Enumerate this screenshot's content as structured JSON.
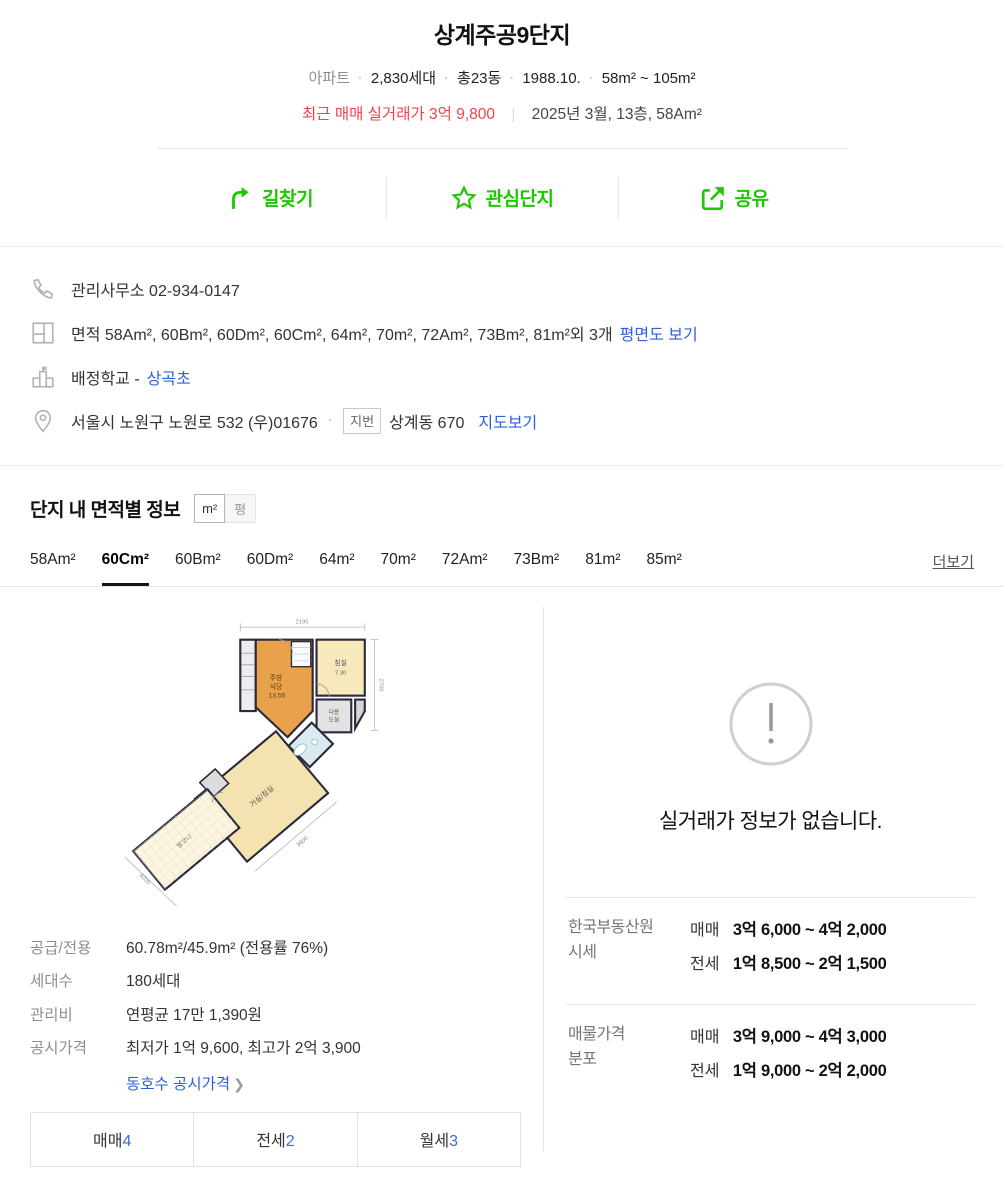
{
  "colors": {
    "accent_green": "#1ec800",
    "price_red": "#f1434b",
    "link_blue": "#3060dd",
    "count_blue": "#3b6bd6"
  },
  "header": {
    "title": "상계주공9단지",
    "meta": [
      "아파트",
      "2,830세대",
      "총23동",
      "1988.10.",
      "58m² ~ 105m²"
    ],
    "recent_price": "최근 매매 실거래가 3억 9,800",
    "recent_detail": "2025년 3월, 13층, 58Am²"
  },
  "actions": [
    {
      "label": "길찾기",
      "icon": "directions-icon"
    },
    {
      "label": "관심단지",
      "icon": "star-icon"
    },
    {
      "label": "공유",
      "icon": "share-icon"
    }
  ],
  "info_rows": {
    "office": {
      "text": "관리사무소 02-934-0147"
    },
    "area": {
      "text": "면적 58Am², 60Bm², 60Dm², 60Cm², 64m², 70m², 72Am², 73Bm², 81m²외 3개",
      "link": "평면도 보기"
    },
    "school": {
      "text": "배정학교 -",
      "link": "상곡초"
    },
    "address": {
      "road": "서울시 노원구 노원로 532 (우)01676",
      "badge": "지번",
      "jibun": "상계동 670",
      "link": "지도보기"
    }
  },
  "section": {
    "title": "단지 내 면적별 정보",
    "unit_toggle": [
      "m²",
      "평"
    ],
    "tabs": [
      {
        "label": "58Am²",
        "active": false
      },
      {
        "label": "60Cm²",
        "active": true
      },
      {
        "label": "60Bm²",
        "active": false
      },
      {
        "label": "60Dm²",
        "active": false
      },
      {
        "label": "64m²",
        "active": false
      },
      {
        "label": "70m²",
        "active": false
      },
      {
        "label": "72Am²",
        "active": false
      },
      {
        "label": "73Bm²",
        "active": false
      },
      {
        "label": "81m²",
        "active": false
      },
      {
        "label": "85m²",
        "active": false
      }
    ],
    "more": "더보기"
  },
  "floorplan": {
    "rooms": {
      "kitchen_line1": "주방",
      "kitchen_line2": "식당",
      "kitchen_area": "13.55",
      "bedroom": "침실",
      "bedroom_area": "7.30",
      "utility_line1": "다용",
      "utility_line2": "도실",
      "living": "거실/침실",
      "balcony": "발코니"
    },
    "dims": {
      "top": "2190",
      "right": "2700",
      "bottom_right": "3600",
      "bottom_left": "4200"
    }
  },
  "details": {
    "rows": [
      {
        "label": "공급/전용",
        "value": "60.78m²/45.9m² (전용률 76%)"
      },
      {
        "label": "세대수",
        "value": "180세대"
      },
      {
        "label": "관리비",
        "value": "연평균 17만 1,390원"
      },
      {
        "label": "공시가격",
        "value": "최저가 1억 9,600, 최고가 2억 3,900"
      }
    ],
    "price_link": "동호수 공시가격"
  },
  "listing_buttons": [
    {
      "label": "매매",
      "count": "4"
    },
    {
      "label": "전세",
      "count": "2"
    },
    {
      "label": "월세",
      "count": "3"
    }
  ],
  "right_panel": {
    "empty_message": "실거래가 정보가 없습니다.",
    "sections": [
      {
        "label_lines": [
          "한국부동산원",
          "시세"
        ],
        "rows": [
          {
            "type": "매매",
            "range": "3억 6,000 ~ 4억 2,000"
          },
          {
            "type": "전세",
            "range": "1억 8,500 ~ 2억 1,500"
          }
        ]
      },
      {
        "label_lines": [
          "매물가격",
          "분포"
        ],
        "rows": [
          {
            "type": "매매",
            "range": "3억 9,000 ~ 4억 3,000"
          },
          {
            "type": "전세",
            "range": "1억 9,000 ~ 2억 2,000"
          }
        ]
      }
    ]
  }
}
